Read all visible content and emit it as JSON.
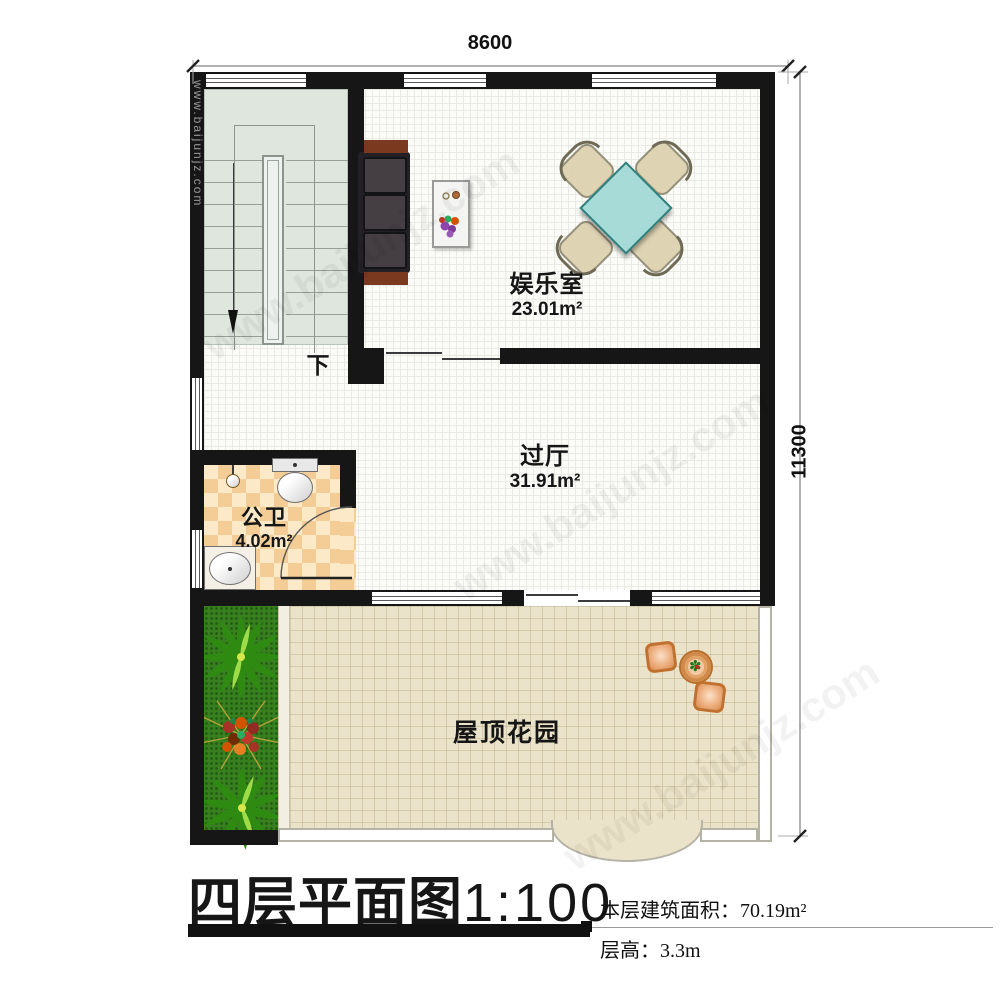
{
  "dimensions": {
    "width_label": "8600",
    "height_label": "11300"
  },
  "plan": {
    "rooms": [
      {
        "name": "娱乐室",
        "area": "23.01m²"
      },
      {
        "name": "过厅",
        "area": "31.91m²"
      },
      {
        "name": "公卫",
        "area": "4.02m²"
      },
      {
        "name": "屋顶花园",
        "area": ""
      }
    ],
    "stair_label": "下"
  },
  "title": {
    "main": "四层平面图",
    "scale": "1:100"
  },
  "info": {
    "area_label": "本层建筑面积：",
    "area_value": "70.19m²",
    "height_label": "层高：",
    "height_value": "3.3m"
  },
  "watermark": {
    "text": "www.baijunjz.com"
  },
  "colors": {
    "wall": "#161616",
    "stair-floor": "#dfe6dd",
    "checker-a": "#f3cd95",
    "checker-b": "#fbe9c8",
    "garden-floor": "#ebe3c9",
    "grass": "#38801f",
    "table-teal": "#a7dbd8",
    "wood": "#7b3a20",
    "chair-beige": "#ded3b3",
    "garden-wood": "#e9a873"
  }
}
